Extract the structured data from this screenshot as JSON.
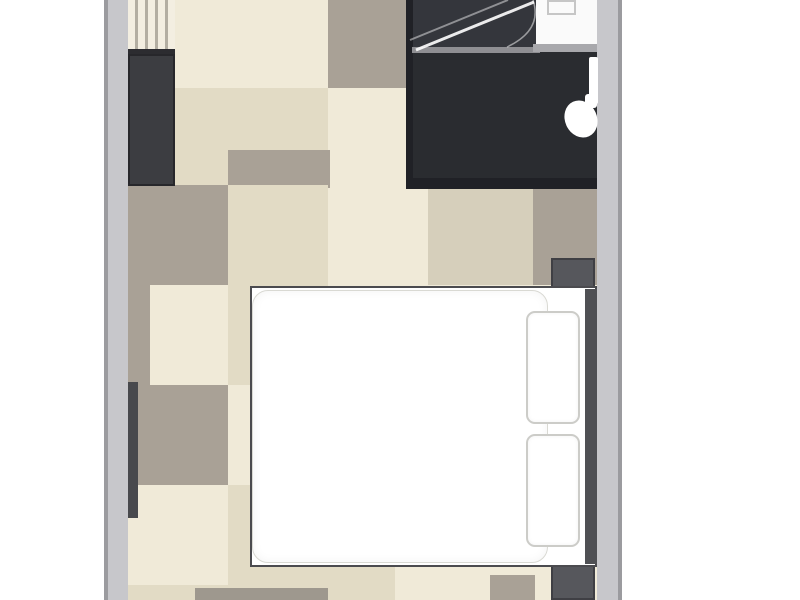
{
  "meta": {
    "type": "floor-plan",
    "room": "hotel-guest-room",
    "visible_text": []
  },
  "palette": {
    "canvas": "#ffffff",
    "floor_cream": "#f0ead8",
    "floor_beige": "#e2dbc5",
    "floor_taupe": "#a9a196",
    "floor_beige_gray": "#d6cfbb",
    "floor_gray_band": "#9e988e",
    "wall": "#c7c7cb",
    "wall_edge": "#9b9b9f",
    "bathroom_floor": "#2a2c30",
    "shower_floor": "#34363c",
    "bathroom_wall": "#202126",
    "shower_divider": "#8f8f93",
    "counter_white": "#fafafa",
    "counter_edge": "#a8a8ac",
    "furniture_dark": "#3c3d41",
    "nightstand_gray": "#56575c",
    "window_marker": "#48494d",
    "bed_white": "#ffffff",
    "bed_frame": "#4b4b4f",
    "outline_light": "#d9d9d3"
  },
  "shapes": [
    {
      "name": "floor-base",
      "x": 128,
      "y": 0,
      "w": 469,
      "h": 600,
      "color": "#f0ead8"
    },
    {
      "name": "floor-tile-taupe-top",
      "x": 328,
      "y": 0,
      "w": 100,
      "h": 88,
      "color": "#a9a196"
    },
    {
      "name": "floor-tile-beige-r1c0",
      "x": 128,
      "y": 88,
      "w": 100,
      "h": 97,
      "color": "#e2dbc5"
    },
    {
      "name": "floor-tile-beige-r1c1",
      "x": 228,
      "y": 88,
      "w": 100,
      "h": 62,
      "color": "#e2dbc5"
    },
    {
      "name": "floor-tile-taupe-r1c1",
      "x": 228,
      "y": 150,
      "w": 102,
      "h": 38,
      "color": "#a9a196"
    },
    {
      "name": "floor-tile-taupe-r2c0",
      "x": 128,
      "y": 185,
      "w": 100,
      "h": 100,
      "color": "#a9a196"
    },
    {
      "name": "floor-tile-beige-r2c1",
      "x": 228,
      "y": 185,
      "w": 100,
      "h": 100,
      "color": "#e2dbc5"
    },
    {
      "name": "floor-tile-beigegray-r2c3",
      "x": 428,
      "y": 188,
      "w": 105,
      "h": 97,
      "color": "#d6cfbb"
    },
    {
      "name": "floor-tile-taupe-r2c4",
      "x": 533,
      "y": 188,
      "w": 64,
      "h": 97,
      "color": "#a9a196"
    },
    {
      "name": "floor-tile-taupe-sliver",
      "x": 128,
      "y": 285,
      "w": 22,
      "h": 100,
      "color": "#a9a196"
    },
    {
      "name": "floor-tile-beige-r3c1",
      "x": 228,
      "y": 285,
      "w": 100,
      "h": 100,
      "color": "#e2dbc5"
    },
    {
      "name": "floor-tile-taupe-r4c0",
      "x": 128,
      "y": 385,
      "w": 100,
      "h": 100,
      "color": "#a9a196"
    },
    {
      "name": "floor-tile-beige-r5c1",
      "x": 228,
      "y": 485,
      "w": 100,
      "h": 115,
      "color": "#e2dbc5"
    },
    {
      "name": "floor-tile-beige-r6c0",
      "x": 128,
      "y": 585,
      "w": 100,
      "h": 15,
      "color": "#e2dbc5"
    },
    {
      "name": "floor-gray-band-bottom",
      "x": 195,
      "y": 588,
      "w": 135,
      "h": 12,
      "color": "#9e988e"
    },
    {
      "name": "floor-tile-beige-below-bed",
      "x": 328,
      "y": 565,
      "w": 67,
      "h": 35,
      "color": "#e2dbc5"
    },
    {
      "name": "floor-tile-taupe-below-bed",
      "x": 490,
      "y": 575,
      "w": 45,
      "h": 25,
      "color": "#a9a196"
    },
    {
      "name": "bathroom-floor",
      "x": 406,
      "y": 0,
      "w": 191,
      "h": 188,
      "color": "#2a2c30"
    },
    {
      "name": "shower-floor",
      "x": 412,
      "y": 0,
      "w": 128,
      "h": 52,
      "color": "#34363c"
    },
    {
      "name": "bathroom-left-wall",
      "x": 406,
      "y": 0,
      "w": 7,
      "h": 188,
      "color": "#202126"
    },
    {
      "name": "bathroom-bottom-wall",
      "x": 406,
      "y": 178,
      "w": 191,
      "h": 11,
      "color": "#202126"
    },
    {
      "name": "shower-divider-line",
      "x": 412,
      "y": 47,
      "w": 128,
      "h": 6,
      "color": "#8f8f93"
    },
    {
      "name": "sink-counter",
      "x": 536,
      "y": 0,
      "w": 61,
      "h": 47,
      "color": "#fafafa"
    },
    {
      "name": "sink-counter-edge",
      "x": 533,
      "y": 44,
      "w": 64,
      "h": 8,
      "color": "#a8a8ac"
    },
    {
      "name": "sink-basin-outline",
      "x": 547,
      "y": 0,
      "w": 29,
      "h": 15,
      "border": "2px solid #c6c6c6"
    },
    {
      "name": "luggage-rack",
      "x": 128,
      "y": 0,
      "w": 47,
      "h": 53,
      "cls": "rack"
    },
    {
      "name": "luggage-rack-edge",
      "x": 128,
      "y": 49,
      "w": 47,
      "h": 5,
      "color": "#2c2c30"
    },
    {
      "name": "wardrobe",
      "x": 128,
      "y": 54,
      "w": 47,
      "h": 132,
      "color": "#3c3d41",
      "border": "2px solid #27272b"
    },
    {
      "name": "window-marker",
      "x": 128,
      "y": 382,
      "w": 10,
      "h": 136,
      "color": "#48494d"
    },
    {
      "name": "nightstand-top",
      "x": 551,
      "y": 258,
      "w": 44,
      "h": 36,
      "color": "#56575c",
      "border": "2px solid #3f3f44"
    },
    {
      "name": "nightstand-bottom",
      "x": 551,
      "y": 563,
      "w": 44,
      "h": 37,
      "color": "#56575c",
      "border": "2px solid #3f3f44"
    },
    {
      "name": "bed-base",
      "x": 250,
      "y": 286,
      "w": 347,
      "h": 281,
      "color": "#ffffff",
      "border": "2px solid #4b4b4f"
    },
    {
      "name": "bed-headboard",
      "x": 585,
      "y": 289,
      "w": 12,
      "h": 275,
      "color": "#4f5054"
    },
    {
      "name": "bed-duvet",
      "x": 252,
      "y": 290,
      "w": 296,
      "h": 273,
      "color": "#ffffff",
      "border": "1px solid #d9d9d3",
      "radius": 16,
      "cls": "duvet"
    },
    {
      "name": "bed-pillow-1",
      "x": 526,
      "y": 311,
      "w": 54,
      "h": 113,
      "color": "#ffffff",
      "border": "2px solid #ccccc8",
      "radius": 9,
      "cls": "pillow"
    },
    {
      "name": "bed-pillow-2",
      "x": 526,
      "y": 434,
      "w": 54,
      "h": 113,
      "color": "#ffffff",
      "border": "2px solid #ccccc8",
      "radius": 9,
      "cls": "pillow"
    },
    {
      "name": "left-wall",
      "x": 104,
      "y": 0,
      "w": 24,
      "h": 600,
      "color": "#c7c7cb"
    },
    {
      "name": "left-wall-outer-edge",
      "x": 104,
      "y": 0,
      "w": 4,
      "h": 600,
      "color": "#9b9b9f"
    },
    {
      "name": "right-wall",
      "x": 597,
      "y": 0,
      "w": 25,
      "h": 600,
      "color": "#c7c7cb"
    },
    {
      "name": "right-wall-outer-edge",
      "x": 618,
      "y": 0,
      "w": 4,
      "h": 600,
      "color": "#9b9b9f"
    }
  ]
}
